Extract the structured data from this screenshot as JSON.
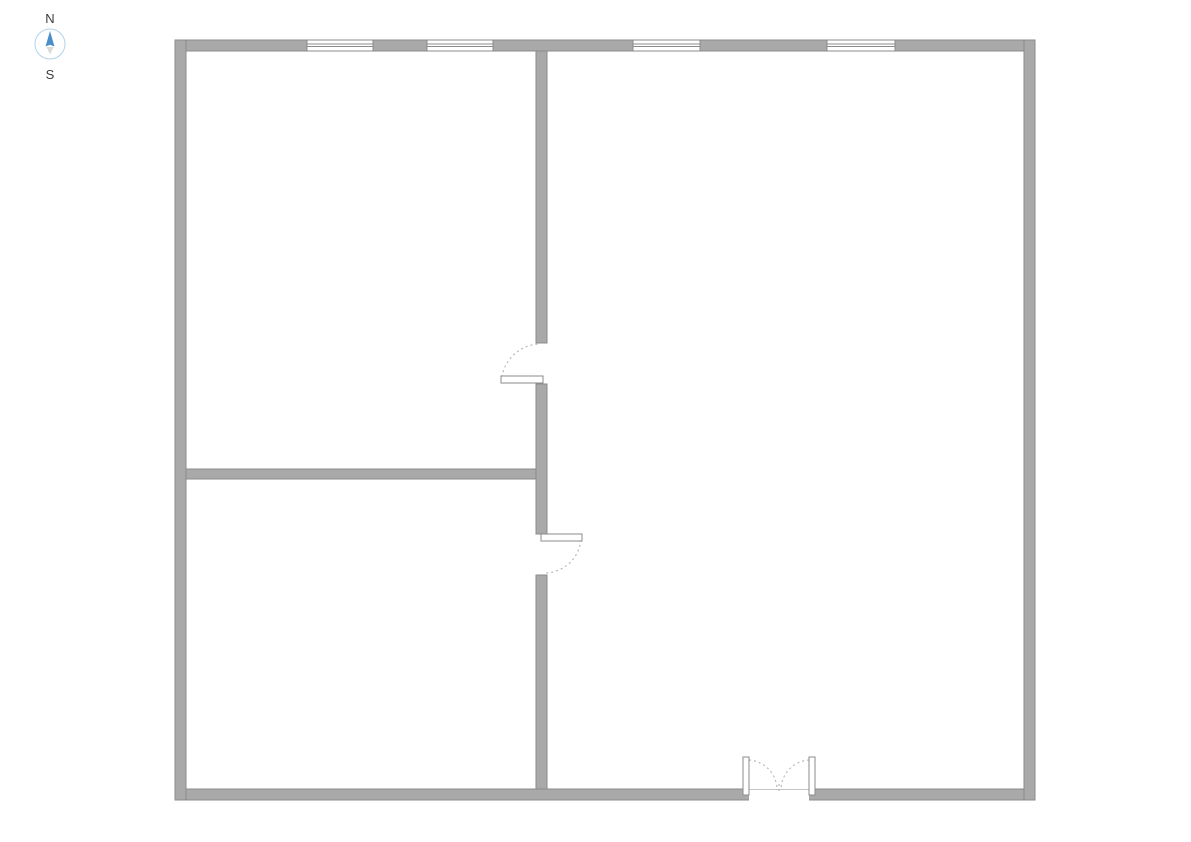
{
  "compass": {
    "north_label": "N",
    "south_label": "S"
  },
  "colors": {
    "background": "#ffffff",
    "wall_fill": "#a9a9a9",
    "wall_edge": "#8b8b8b",
    "window_line": "#8b8b8b",
    "door_panel_fill": "#ffffff",
    "door_panel_edge": "#8b8b8b",
    "door_arc": "#b9b9b9",
    "threshold": "#c4c4c4",
    "compass_north": "#4a8fc8",
    "compass_south": "#d9d9d9",
    "compass_ring": "#aed3ec",
    "compass_text": "#3d3d3d"
  },
  "floor_plan": {
    "rooms": [
      {
        "name": "room-upper-left",
        "x": 186,
        "y": 51,
        "w": 350,
        "h": 418
      },
      {
        "name": "room-lower-left",
        "x": 186,
        "y": 479,
        "w": 350,
        "h": 310
      },
      {
        "name": "room-right",
        "x": 547,
        "y": 51,
        "w": 477,
        "h": 738
      }
    ],
    "outer_walls": [
      {
        "name": "outer-wall-top",
        "x": 175,
        "y": 40,
        "w": 860,
        "h": 11
      },
      {
        "name": "outer-wall-bottom",
        "x": 175,
        "y": 789,
        "w": 860,
        "h": 11
      },
      {
        "name": "outer-wall-left",
        "x": 175,
        "y": 40,
        "w": 11,
        "h": 760
      },
      {
        "name": "outer-wall-right",
        "x": 1024,
        "y": 40,
        "w": 11,
        "h": 760
      }
    ],
    "interior_walls": [
      {
        "name": "interior-wall-vertical-upper",
        "x": 536,
        "y": 51,
        "w": 11,
        "h": 292
      },
      {
        "name": "interior-wall-vertical-middle",
        "x": 536,
        "y": 384,
        "w": 11,
        "h": 150
      },
      {
        "name": "interior-wall-vertical-lower",
        "x": 536,
        "y": 575,
        "w": 11,
        "h": 214
      },
      {
        "name": "interior-wall-horizontal",
        "x": 186,
        "y": 469,
        "w": 350,
        "h": 10
      }
    ],
    "windows": [
      {
        "name": "window-1",
        "x": 307,
        "y": 40,
        "w": 66,
        "h": 11
      },
      {
        "name": "window-2",
        "x": 427,
        "y": 40,
        "w": 66,
        "h": 11
      },
      {
        "name": "window-3",
        "x": 633,
        "y": 40,
        "w": 67,
        "h": 11
      },
      {
        "name": "window-4",
        "x": 827,
        "y": 40,
        "w": 68,
        "h": 11
      }
    ],
    "openings": [
      {
        "name": "entry-opening",
        "x": 749,
        "y": 788,
        "w": 60,
        "h": 14
      }
    ],
    "doors": [
      {
        "name": "interior-door-upper",
        "panel": {
          "x": 501,
          "y": 376,
          "w": 42,
          "h": 7
        },
        "arc": "M 502 377 A 39 39 0 0 1 540 344"
      },
      {
        "name": "interior-door-lower",
        "panel": {
          "x": 541,
          "y": 534,
          "w": 41,
          "h": 7
        },
        "arc": "M 581 540 A 37 37 0 0 1 545 573"
      },
      {
        "name": "entry-double-door-left-leaf",
        "panel": {
          "x": 743,
          "y": 757,
          "w": 6,
          "h": 38
        },
        "arc": "M 749 760 A 30 30 0 0 1 777 789"
      },
      {
        "name": "entry-double-door-right-leaf",
        "panel": {
          "x": 809,
          "y": 757,
          "w": 6,
          "h": 38
        },
        "arc": "M 809 760 A 30 30 0 0 0 781 789"
      }
    ],
    "center_tick": {
      "x": 779,
      "y1": 784,
      "y2": 791
    }
  }
}
